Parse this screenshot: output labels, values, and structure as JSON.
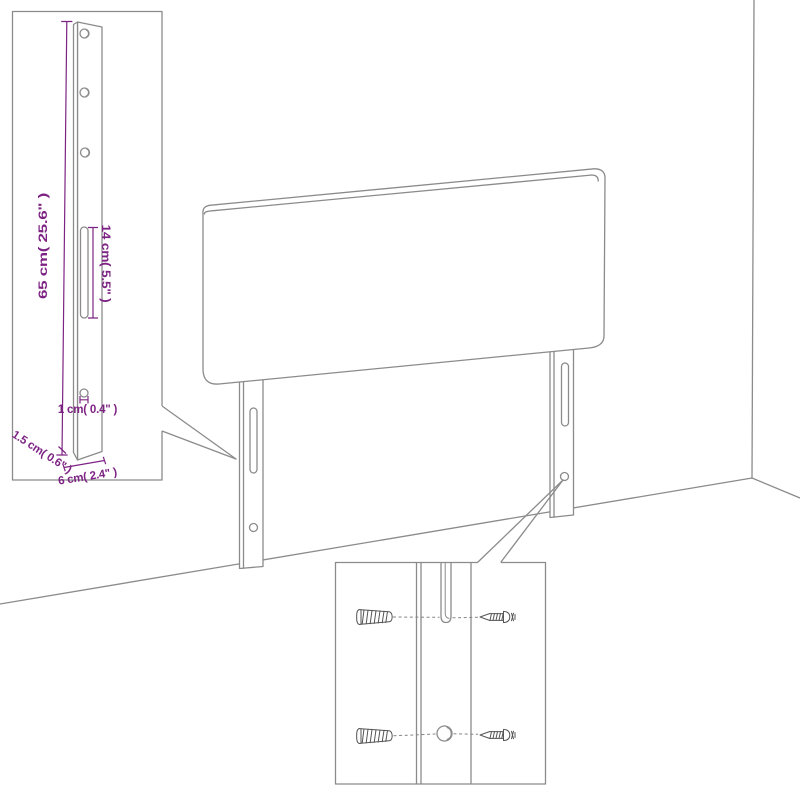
{
  "colors": {
    "background": "#ffffff",
    "line": "#8b8b8b",
    "line_dark": "#555555",
    "dimension": "#7d2383"
  },
  "diagram": {
    "kind": "furniture-assembly-dimension-diagram",
    "scene": {
      "main_object": "headboard-with-two-mounting-legs-in-room-corner",
      "insets": [
        "leg-dimension-detail",
        "wall-mounting-hardware-detail"
      ]
    },
    "leg_detail": {
      "labels": {
        "height": "65 cm( 25.6\" )",
        "slot_length": "14 cm( 5.5\" )",
        "hole_size": "1 cm( 0.4\" )",
        "thickness": "1.5 cm( 0.6\" )",
        "width": "6 cm( 2.4\" )"
      }
    },
    "mounting_detail": {
      "hardware": [
        "wall-plug",
        "screw"
      ]
    }
  }
}
